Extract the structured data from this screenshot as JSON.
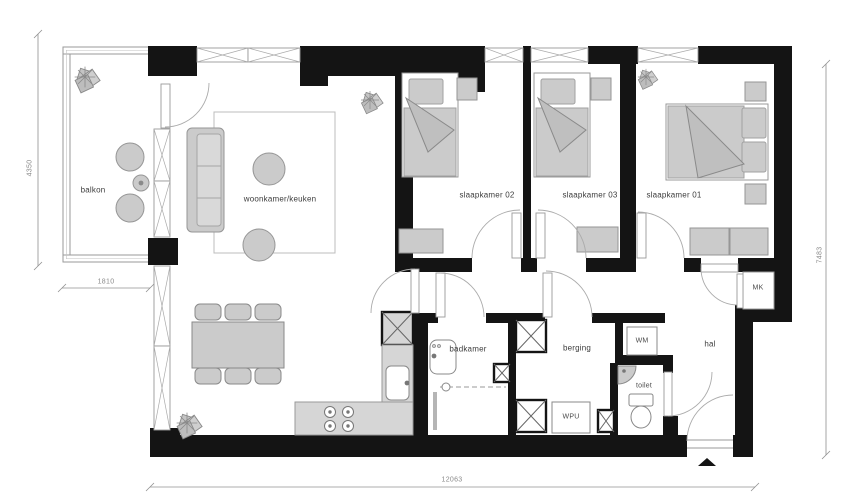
{
  "plan": {
    "rooms": {
      "balkon": "balkon",
      "woonkamer": "woonkamer/keuken",
      "slaapkamer02": "slaapkamer 02",
      "slaapkamer03": "slaapkamer 03",
      "slaapkamer01": "slaapkamer 01",
      "badkamer": "badkamer",
      "berging": "berging",
      "hal": "hal",
      "toilet": "toilet"
    },
    "units": {
      "wm": "WM",
      "wpu": "WPU",
      "mk": "MK"
    },
    "dimensions": {
      "balcony_height_mm": "4350",
      "balcony_width_mm": "1810",
      "total_width_mm": "12063",
      "total_height_mm": "7483"
    },
    "icons": {
      "entrance_marker": "entrance-direction-triangle"
    },
    "colors": {
      "wall": "#141414",
      "furniture_fill": "#cbcbcb",
      "furniture_stroke": "#969696",
      "thin_line": "#9a9a9a",
      "dim_text": "#8a8a8a"
    }
  }
}
